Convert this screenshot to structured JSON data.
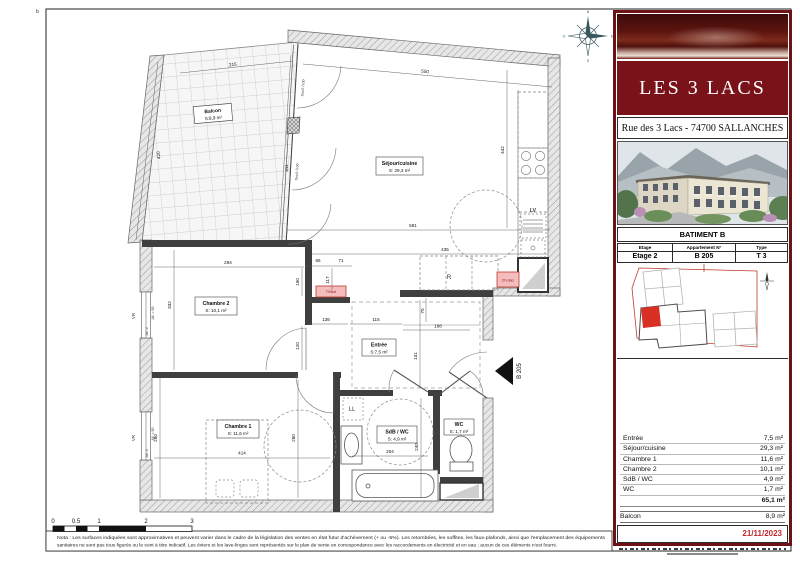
{
  "sheet": {
    "margin_mark": "b",
    "scale_labels": [
      "0",
      "0.5",
      "1",
      "2",
      "3"
    ],
    "nota_line1": "Nota : Les surfaces indiquées sont approximatives et peuvent varier dans le cadre de la législation des ventes en état futur d'achèvement (+ ou -5%). Les retombées, les soffites, les faux-plafonds, ainsi que l'emplacement des équipements",
    "nota_line2": "sanitaires ne sont pas tous figurés ou le sont à titre indicatif. Les éviers et les lave-linges sont représentés sur le plan de vente en correspondance avec les raccordements en électricité et en eau ; aucun de ces éléments n'est fourni."
  },
  "plan": {
    "rooms": {
      "balcon": {
        "name": "Balcon",
        "area": "S:8,9 m²"
      },
      "sejour": {
        "name": "Séjour/cuisine",
        "area": "S: 29,3 m²"
      },
      "chambre2": {
        "name": "Chambre 2",
        "area": "S: 10,1 m²"
      },
      "chambre1": {
        "name": "Chambre 1",
        "area": "S: 11,6 m²"
      },
      "entree": {
        "name": "Entrée",
        "area": "S:7,5 m²"
      },
      "sdb": {
        "name": "SdB / WC",
        "area": "S: 4,9 m²"
      },
      "wc": {
        "name": "WC",
        "area": "S: 1,7 m²"
      }
    },
    "labels": {
      "lv": "LV",
      "r": "R",
      "ll": "LL",
      "ch_gaz": "Ch.Gaz",
      "t_elect": "T.Elect",
      "unit": "B 205",
      "seuil": "Seuil: 0,00",
      "vr": "VR",
      "all50": "All. = 50",
      "allv": "All. V.",
      "compass_n": "N",
      "compass_s": "S",
      "compass_e": "E",
      "compass_o": "O"
    },
    "dims": {
      "d215": "215",
      "d550": "550",
      "d581": "581",
      "d442": "442",
      "d420": "420",
      "d411": "411",
      "d294": "294",
      "d332": "332",
      "d65": "65",
      "d71": "71",
      "d117": "117",
      "d150": "150",
      "d136": "136",
      "d115": "115",
      "d120": "120",
      "d131": "131",
      "d435": "435",
      "d70": "70",
      "d168": "168",
      "d204": "204",
      "d240": "240",
      "d280a": "280",
      "d280b": "280",
      "d414": "414"
    }
  },
  "panel": {
    "title": "LES 3 LACS",
    "address": "Rue des 3 Lacs - 74700 SALLANCHES",
    "batiment": "BATIMENT B",
    "info": {
      "headers": [
        "Etage",
        "Appartement N°",
        "Type"
      ],
      "values": [
        "Etage 2",
        "B 205",
        "T 3"
      ]
    },
    "areas": [
      {
        "label": "Entrée",
        "value": "7,5 m²"
      },
      {
        "label": "Séjour/cuisine",
        "value": "29,3 m²"
      },
      {
        "label": "Chambre 1",
        "value": "11,6 m²"
      },
      {
        "label": "Chambre 2",
        "value": "10,1 m²"
      },
      {
        "label": "SdB / WC",
        "value": "4,9 m²"
      },
      {
        "label": "WC",
        "value": "1,7 m²"
      }
    ],
    "total": "65,1 m²",
    "balcon": {
      "label": "Balcon",
      "value": "8,9 m²"
    },
    "date": "21/11/2023"
  },
  "colors": {
    "maroon": "#7a121a",
    "red": "#c0272d",
    "wall": "#3f3f3f"
  }
}
